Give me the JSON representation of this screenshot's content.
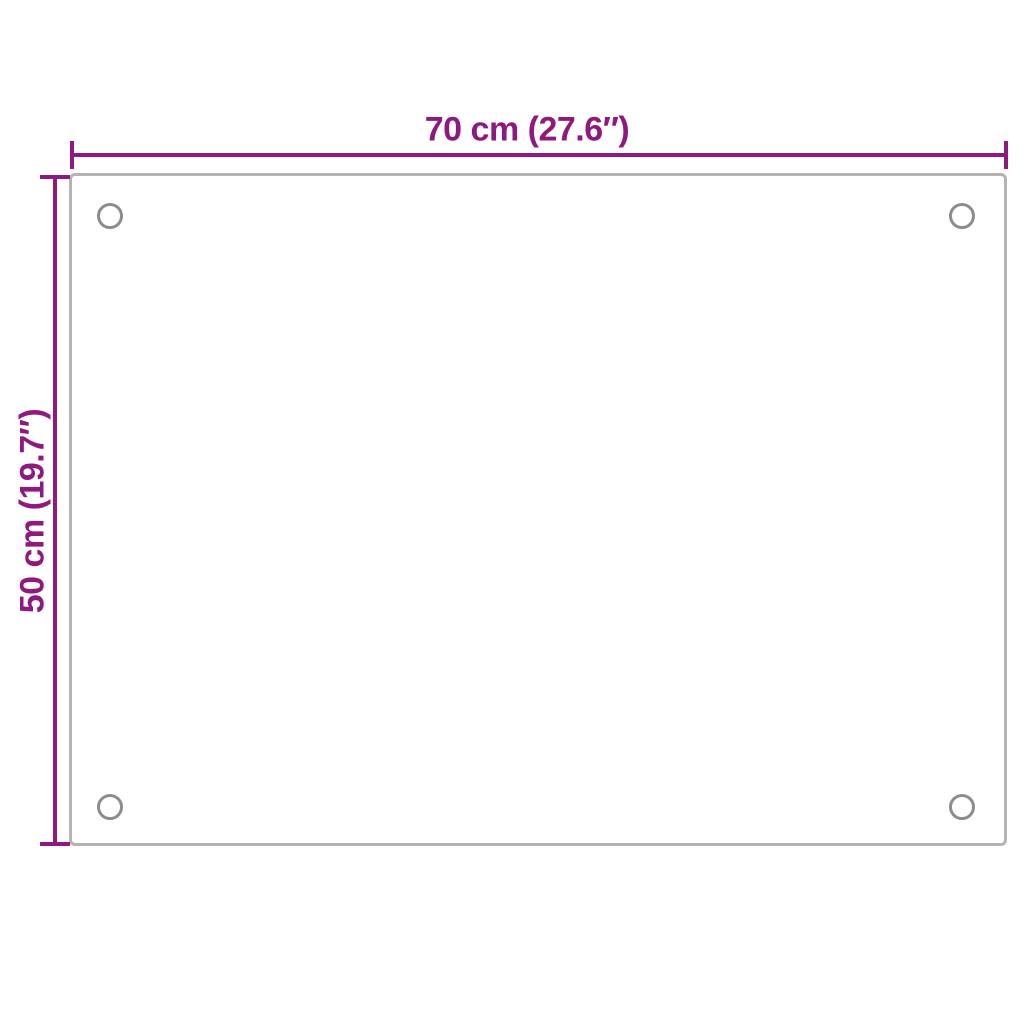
{
  "diagram": {
    "title": "product-dimension-diagram",
    "labels": {
      "width": "70 cm (27.6″)",
      "height": "50 cm (19.7″)"
    },
    "colors": {
      "dimension-accent": "#8E1A80",
      "panel-border": "#B4B4B4",
      "hole-stroke": "#8C8C8C",
      "background": "#FFFFFF"
    },
    "panel": {
      "shape": "rectangle",
      "mounting_holes": 4
    }
  }
}
